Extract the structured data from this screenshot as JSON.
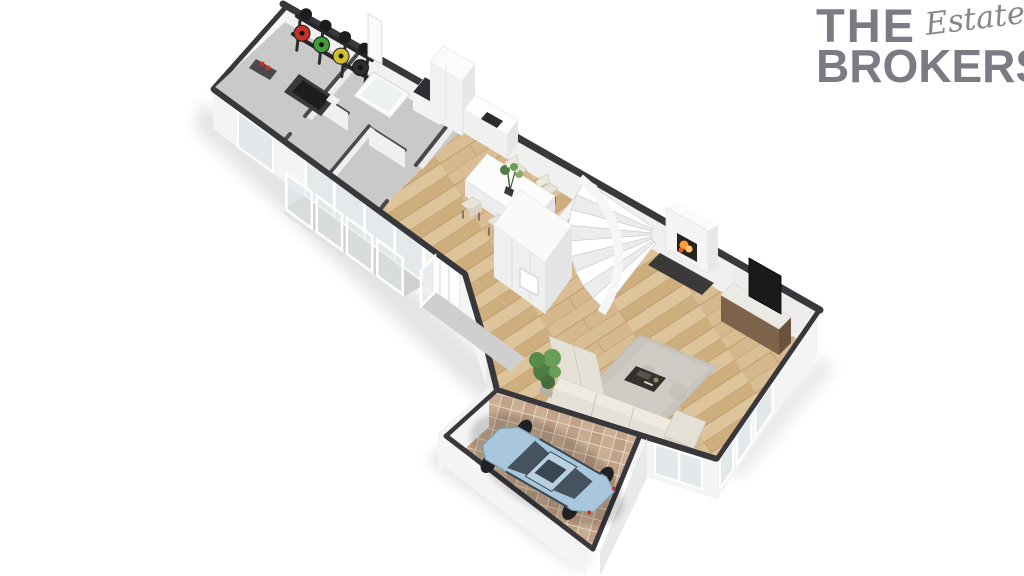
{
  "brand": {
    "word1": "THE",
    "word2": "Estate",
    "word3": "BROKERS",
    "color": "#7b7b83"
  },
  "scene": {
    "description": "3D isometric floor plan render of an apartment with garage",
    "rooms": [
      "gym",
      "bathroom",
      "hallway",
      "kitchen",
      "dining-room",
      "entrance-hall",
      "staircase",
      "living-room",
      "garage",
      "balcony",
      "porch"
    ],
    "furniture": [
      "weight-rack",
      "workout-bench",
      "treadmill",
      "bathtub",
      "laundry-counter",
      "kitchen-cabinets",
      "dining-table",
      "dining-chairs",
      "flower-centerpiece",
      "wardrobe",
      "fireplace",
      "tv",
      "media-console",
      "area-rug",
      "coffee-table",
      "corner-sofa",
      "potted-plant",
      "car",
      "glass-balustrade"
    ]
  },
  "colors": {
    "wallCap": "#38383c",
    "wallCapLight": "#4a4a4e",
    "wallFace": "#f4f4f4",
    "wallFaceShade": "#e9e9eb",
    "wallInner": "#f0f0f0",
    "floorGray": "#c9c9c7",
    "floorGrayDark": "#d2d2d0",
    "balconyFloor": "#d0d0ce",
    "woodBase": "#d6b88c",
    "wood2": "#cfae7e",
    "wood3": "#d9bd93",
    "wood4": "#ddc49b",
    "woodSeam": "#bd9c6f",
    "herrBase": "#e3d8c8",
    "herr1": "#c9ab90",
    "herr2": "#bfa084",
    "herr3": "#c3a287",
    "herr4": "#cbaf95",
    "glass": "#dfe6e9",
    "frame": "#ffffff",
    "sofa": "#e6e1d6",
    "sofaShade": "#d8d3c7",
    "sofaLight": "#efeadf",
    "sofaSeam": "#cdc8bc",
    "rug": "#c9c5be",
    "rugLight": "#d3cfc8",
    "dark": "#2c2c2f",
    "tv": "#1a1a1d",
    "consoleWood": "#7d6349",
    "consoleWoodDark": "#6a523c",
    "marble": "#eceae5",
    "fire1": "#ff9a3c",
    "fire2": "#ffc873",
    "fire3": "#e25822",
    "hearth": "#2e2e31",
    "plant1": "#4e7d46",
    "plant2": "#699e55",
    "plant3": "#57894b",
    "plant4": "#436e3c",
    "carBody": "#a9c7dc",
    "carEdge": "#7d9fb7",
    "carRoof": "#b9d2e2",
    "carGlass": "#46535e",
    "carGlassDark": "#3a4750",
    "wheel": "#1f2123",
    "plateRed": "#c23327",
    "plateGreen": "#3f9c38",
    "plateYellow": "#d4bd2c",
    "plateBlack": "#2e2e31",
    "equip": "#3a3a3e",
    "belt": "#1d1d20"
  }
}
